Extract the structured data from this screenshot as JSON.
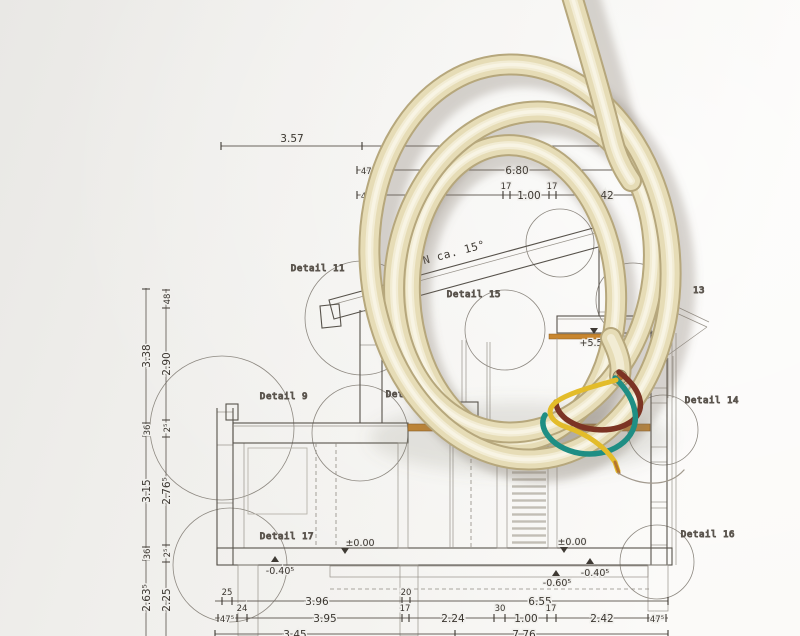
{
  "drawing": {
    "roof_note": "N ca. 15°",
    "details": {
      "d9": "Detail 9",
      "d10": "Detail 10",
      "d11": "Detail 11",
      "d13": "13",
      "d14": "Detail 14",
      "d15": "Detail 15",
      "d16": "Detail 16",
      "d17": "Detail 17"
    },
    "levels": {
      "ridge": "+5.52⁵",
      "zero_left": "±0.00",
      "zero_right": "±0.00",
      "minus040_left": "-0.40⁵",
      "minus040_right": "-0.40⁵",
      "minus060": "-0.60⁵"
    },
    "dims": {
      "top": {
        "w357": "3.57",
        "w475a": "47⁵",
        "w680": "6.80",
        "w475b": "47⁵",
        "s17a": "17",
        "s100": "1.00",
        "s17b": "17",
        "w242": "2.42"
      },
      "bottom1": {
        "s25": "25",
        "w396": "3.96",
        "s20": "20",
        "w655": "6.55"
      },
      "bottom2": {
        "w475a": "47⁵",
        "s24": "24",
        "w395": "3.95",
        "s17a": "17",
        "w224": "2.24",
        "s30": "30",
        "w100": "1.00",
        "s17b": "17",
        "w242": "2.42",
        "w475b": "47⁵"
      },
      "bottom3": {
        "w345": "3.45",
        "w776": "7.76"
      },
      "left_outer": {
        "h338": "3.38",
        "h36a": "36",
        "h315": "3.15",
        "h36b": "36",
        "h2635": "2.63⁵"
      },
      "left_inner": {
        "h48": "48",
        "h290": "2.90",
        "h25a": "2⁵",
        "h2765": "2.76⁵",
        "h25b": "2⁵",
        "h225": "2.25"
      }
    }
  },
  "colors": {
    "paper": "#f2f1ee",
    "ink": "#5d5751",
    "wood_accent": "#c8862f",
    "cable_sheath": "#e6dcb8",
    "wire_brown": "#7c3424",
    "wire_teal": "#1f8e84",
    "wire_yellow": "#e3bc2a",
    "wire_copper": "#b5752f"
  }
}
